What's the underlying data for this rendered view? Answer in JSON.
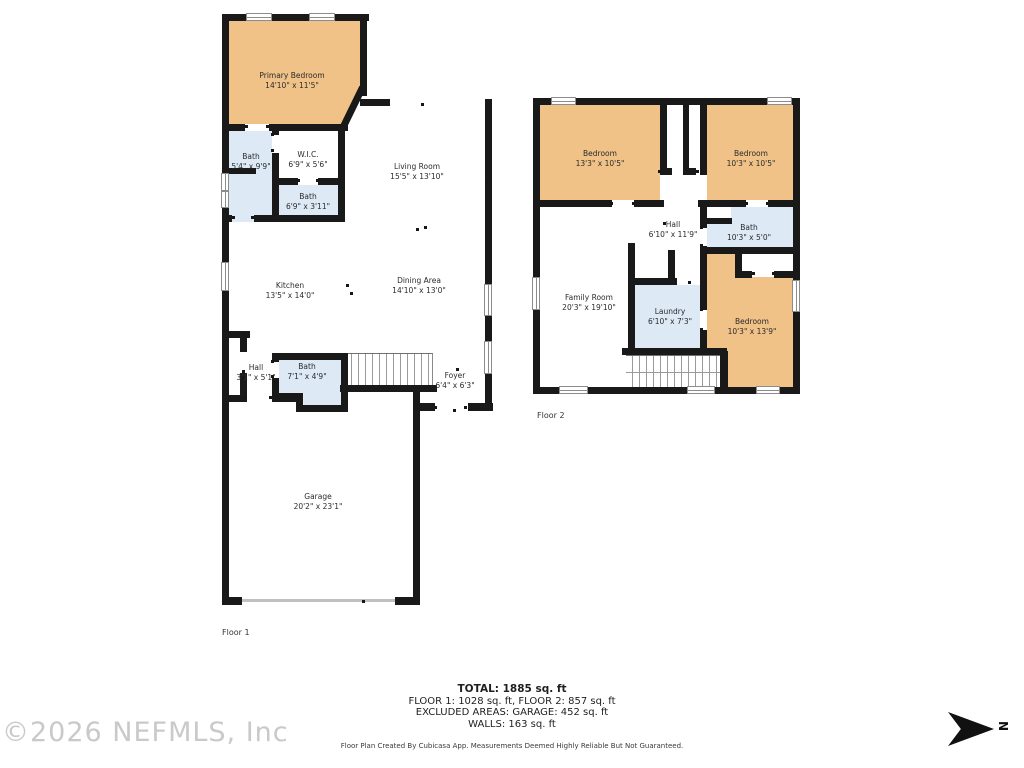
{
  "floors": [
    {
      "label": "Floor 1",
      "rooms": [
        {
          "name": "Primary Bedroom",
          "dims": "14'10\" x 11'5\""
        },
        {
          "name": "Bath",
          "dims": "5'4\" x 9'9\""
        },
        {
          "name": "W.I.C.",
          "dims": "6'9\" x 5'6\""
        },
        {
          "name": "Bath",
          "dims": "6'9\" x 3'11\""
        },
        {
          "name": "Living Room",
          "dims": "15'5\" x 13'10\""
        },
        {
          "name": "Kitchen",
          "dims": "13'5\" x 14'0\""
        },
        {
          "name": "Dining Area",
          "dims": "14'10\" x 13'0\""
        },
        {
          "name": "Hall",
          "dims": "3'1\" x 5'1\""
        },
        {
          "name": "Bath",
          "dims": "7'1\" x 4'9\""
        },
        {
          "name": "Foyer",
          "dims": "6'4\" x 6'3\""
        },
        {
          "name": "Garage",
          "dims": "20'2\" x 23'1\""
        }
      ]
    },
    {
      "label": "Floor 2",
      "rooms": [
        {
          "name": "Bedroom",
          "dims": "13'3\" x 10'5\""
        },
        {
          "name": "Bedroom",
          "dims": "10'3\" x 10'5\""
        },
        {
          "name": "Hall",
          "dims": "6'10\" x 11'9\""
        },
        {
          "name": "Bath",
          "dims": "10'3\" x 5'0\""
        },
        {
          "name": "Family Room",
          "dims": "20'3\" x 19'10\""
        },
        {
          "name": "Laundry",
          "dims": "6'10\" x 7'3\""
        },
        {
          "name": "Bedroom",
          "dims": "10'3\" x 13'9\""
        }
      ]
    }
  ],
  "summary": {
    "total": "TOTAL: 1885 sq. ft",
    "floors_line": "FLOOR 1: 1028 sq. ft, FLOOR 2: 857 sq. ft",
    "excluded_line": "EXCLUDED AREAS: GARAGE: 452 sq. ft",
    "walls_line": "WALLS: 163 sq. ft"
  },
  "disclaimer": "Floor Plan Created By Cubicasa App. Measurements Deemed Highly Reliable But Not Guaranteed.",
  "watermark": "©2026 NEFMLS, Inc",
  "compass_label": "N",
  "colors": {
    "bedroom_fill": "#F0C287",
    "wet_room_fill": "#DDEAF6",
    "wall": "#191919"
  }
}
